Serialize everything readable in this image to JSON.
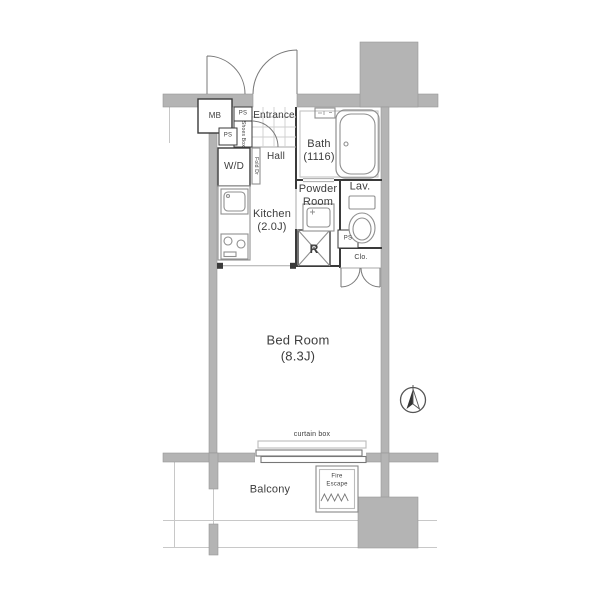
{
  "labels": {
    "mb": "MB",
    "ps": "PS",
    "shoes_box": "Shoes Box",
    "wd": "W/D",
    "fold_door": "Fold Dr",
    "hall": "Hall",
    "entrance": "Entrance",
    "bath_name": "Bath",
    "bath_size": "(1116)",
    "powder_line1": "Powder",
    "powder_line2": "Room",
    "lav": "Lav.",
    "kitchen_name": "Kitchen",
    "kitchen_size": "(2.0J)",
    "refrigerator": "R",
    "closet": "Clo.",
    "bedroom_name": "Bed Room",
    "bedroom_size": "(8.3J)",
    "curtain_box": "curtain box",
    "balcony": "Balcony",
    "fire_escape_line1": "Fire",
    "fire_escape_line2": "Escape"
  },
  "colors": {
    "wall_gray": "#b4b4b4",
    "wall_dark": "#3a3a3a",
    "fixture_line": "#8f8f8f",
    "text": "#3d3d3d",
    "background": "#ffffff"
  }
}
